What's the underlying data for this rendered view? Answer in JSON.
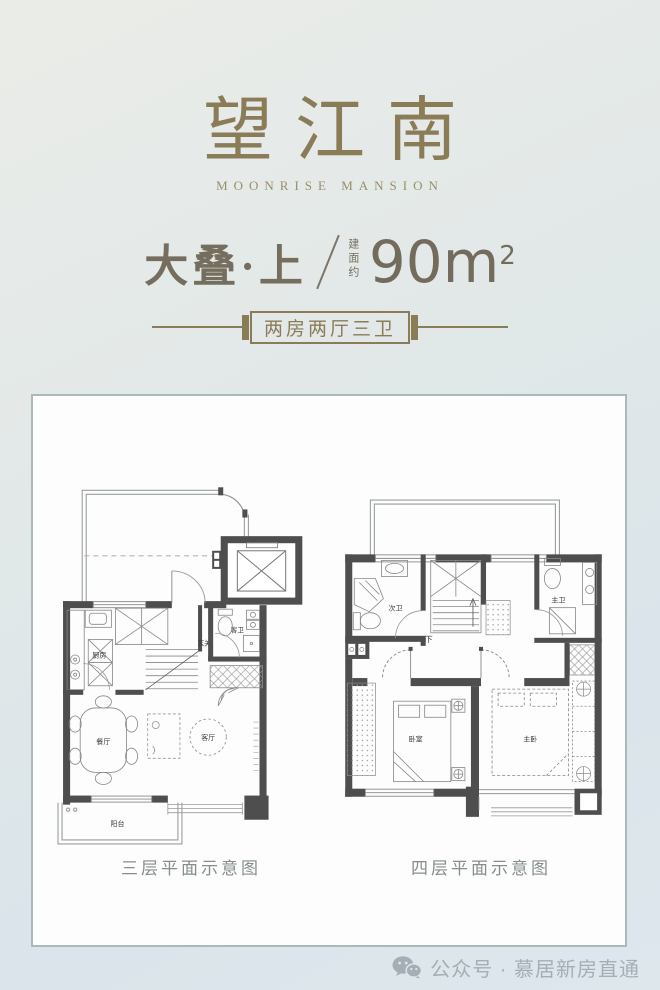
{
  "header": {
    "title": "望江南",
    "subtitle": "MOONRISE MANSION",
    "unit_type": "大叠·上",
    "area_label": "建面约",
    "area_value": "90m",
    "area_exponent": "2",
    "badge_label": "两房两厅三卫"
  },
  "plans": {
    "left": {
      "caption": "三层平面示意图",
      "labels": {
        "kitchen": "厨房",
        "hall": "玄关",
        "guest_bath": "客卫",
        "dining": "餐厅",
        "living": "客厅",
        "balcony": "阳台"
      }
    },
    "right": {
      "caption": "四层平面示意图",
      "labels": {
        "second_bath": "次卫",
        "stairs_down": "下",
        "master_bath": "主卫",
        "bedroom": "卧室",
        "master_bedroom": "主卧"
      }
    }
  },
  "footer": {
    "account_label": "公众号 · 慕居新房直通"
  },
  "colors": {
    "accent": "#8b7c58",
    "spec_text": "#756e5e",
    "wall": "#4e4e4e",
    "caption": "#868e8c",
    "footer_text": "#a6aeb5",
    "panel_bg": "#fdfdfd",
    "panel_border": "#a9b9bc"
  }
}
